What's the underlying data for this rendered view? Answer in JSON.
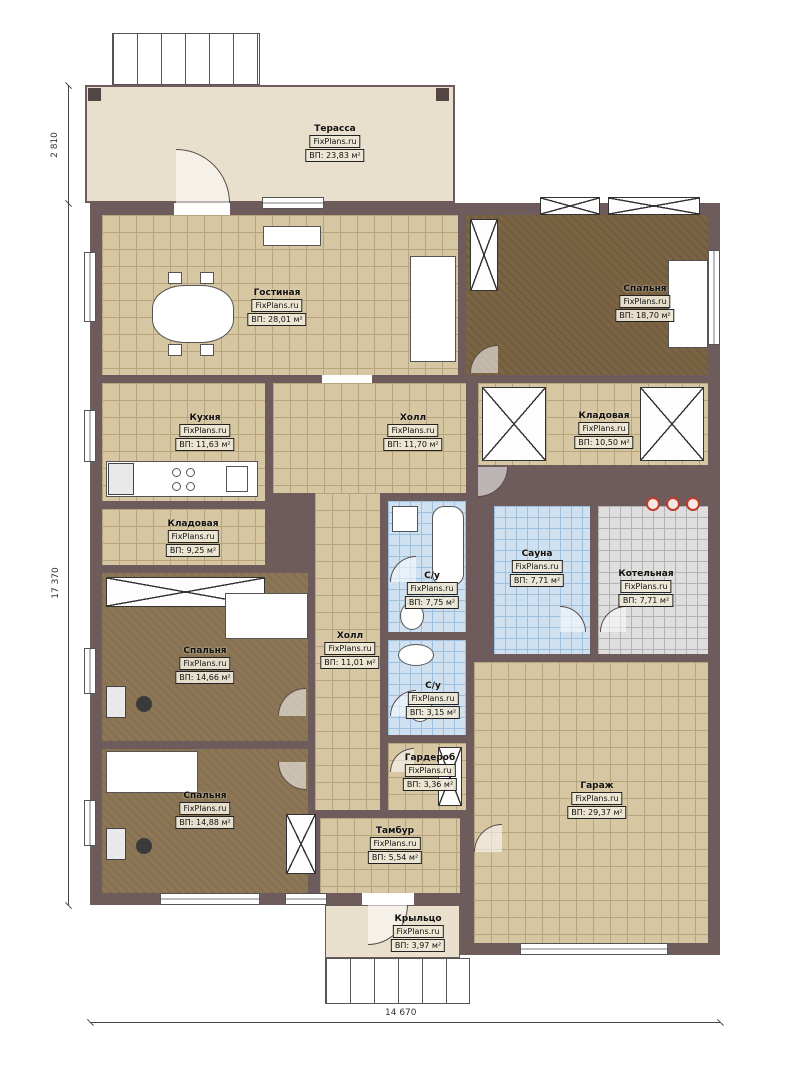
{
  "brand": "FixPlans.ru",
  "rooms": [
    {
      "name": "Терасса",
      "area": "ВП: 23,83 м²"
    },
    {
      "name": "Гостиная",
      "area": "ВП: 28,01 м²"
    },
    {
      "name": "Спальня",
      "area": "ВП: 18,70 м²"
    },
    {
      "name": "Кухня",
      "area": "ВП: 11,63 м²"
    },
    {
      "name": "Холл",
      "area": "ВП: 11,70 м²"
    },
    {
      "name": "Кладовая",
      "area": "ВП: 10,50 м²"
    },
    {
      "name": "Кладовая",
      "area": "ВП: 9,25 м²"
    },
    {
      "name": "С/у",
      "area": "ВП: 7,75 м²"
    },
    {
      "name": "Сауна",
      "area": "ВП: 7,71 м²"
    },
    {
      "name": "Котельная",
      "area": "ВП: 7,71 м²"
    },
    {
      "name": "Холл",
      "area": "ВП: 11,01 м²"
    },
    {
      "name": "Спальня",
      "area": "ВП: 14,66 м²"
    },
    {
      "name": "С/у",
      "area": "ВП: 3,15 м²"
    },
    {
      "name": "Гардероб",
      "area": "ВП: 3,36 м²"
    },
    {
      "name": "Спальня",
      "area": "ВП: 14,88 м²"
    },
    {
      "name": "Тамбур",
      "area": "ВП: 5,54 м²"
    },
    {
      "name": "Гараж",
      "area": "ВП: 29,37 м²"
    },
    {
      "name": "Крыльцо",
      "area": "ВП: 3,97 м²"
    }
  ],
  "dimensions": {
    "terrace_height": "2 810",
    "house_height": "17 370",
    "house_width": "14 670"
  },
  "colors": {
    "wall": "#6d5c5b",
    "floor_tile": "#d7c6a2",
    "floor_wood": "#8c7656",
    "floor_wood_dark": "#7b6443",
    "tile_wet": "#cfe0f0",
    "tile_boiler": "#dedede",
    "terrace": "#e8dfcc"
  }
}
